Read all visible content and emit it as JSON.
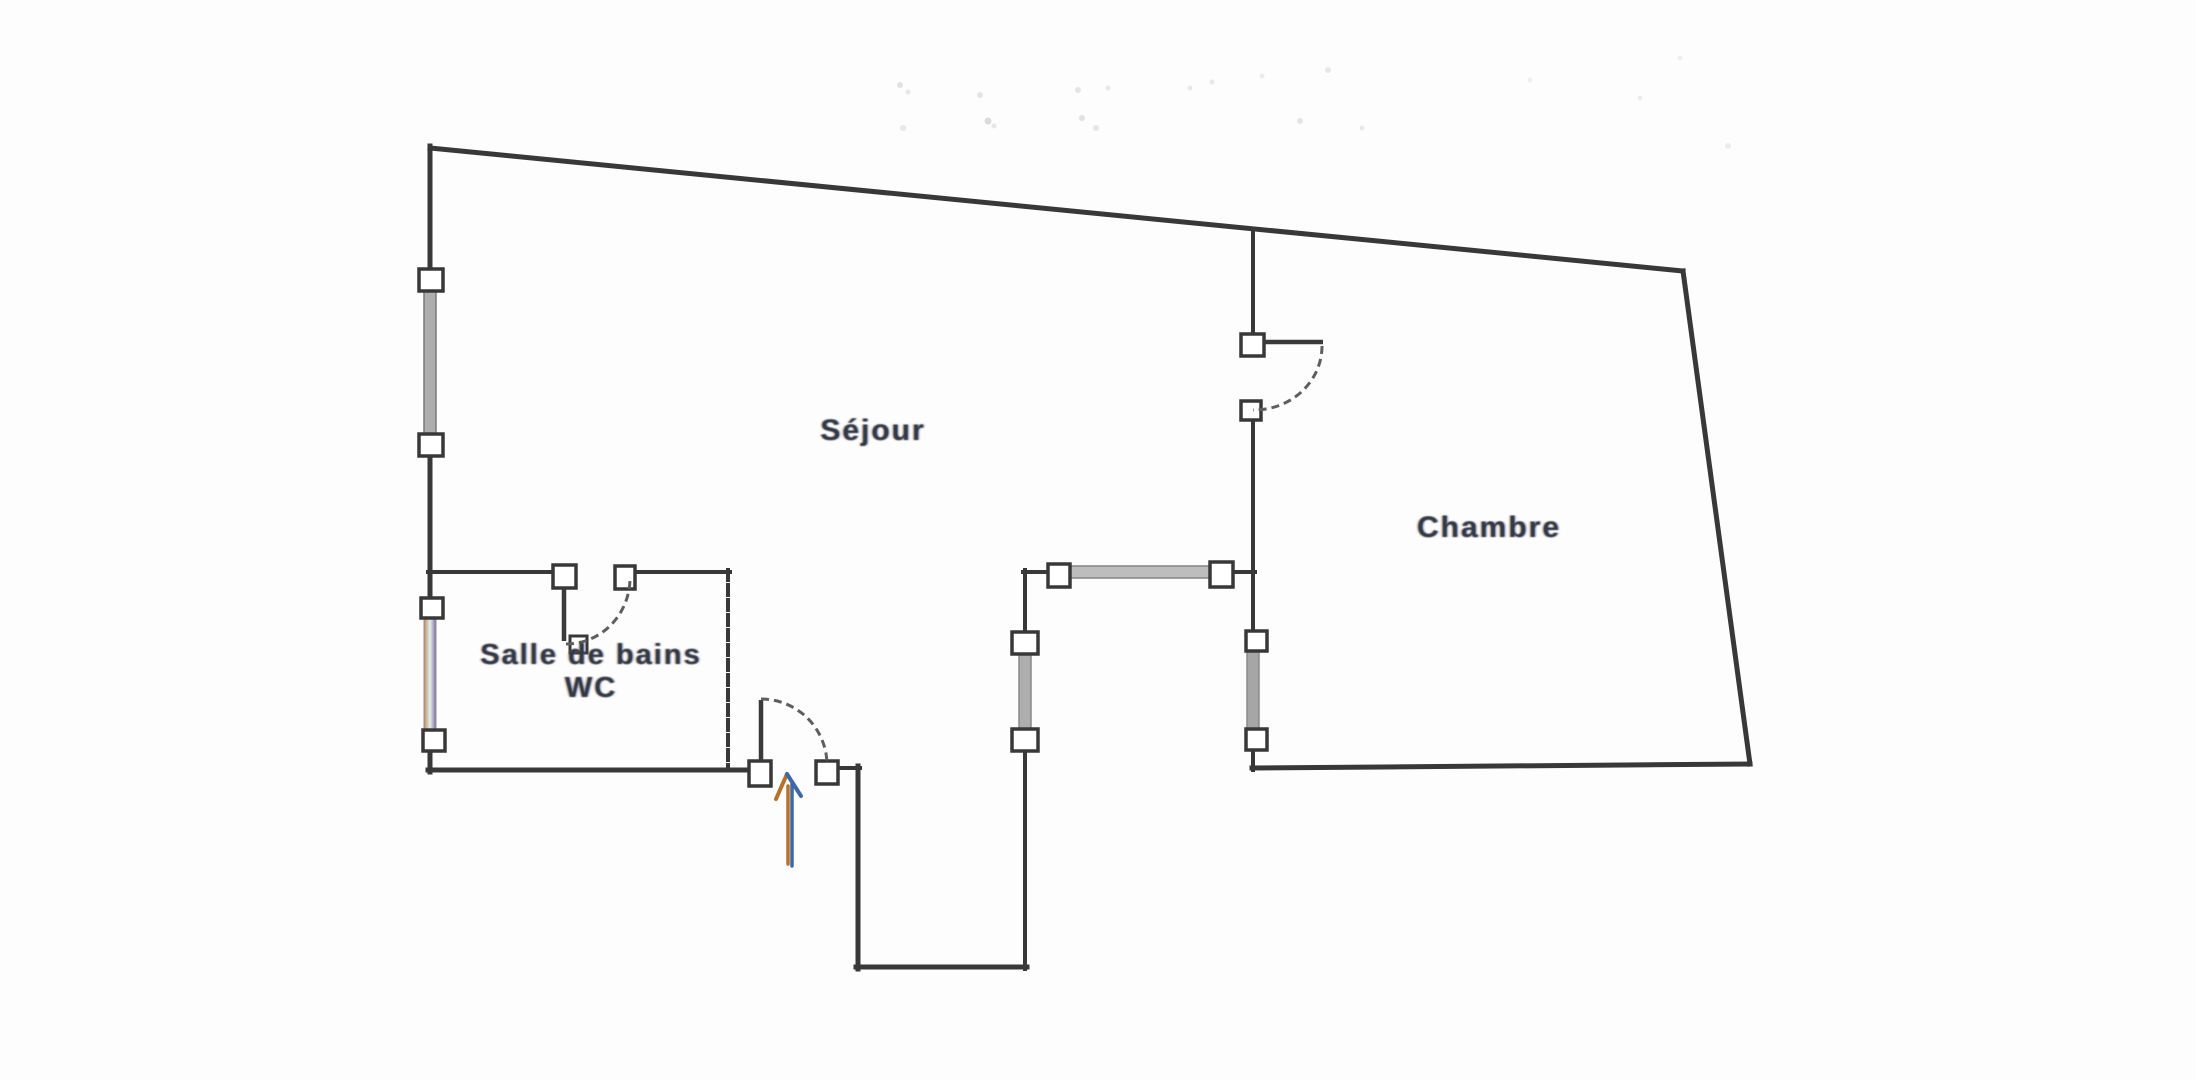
{
  "document": {
    "kind": "apartment floor plan (scanned drawing)",
    "background_color": "#fdfdfd"
  },
  "rooms": {
    "sejour": {
      "label": "Séjour"
    },
    "chambre": {
      "label": "Chambre"
    },
    "salle_de_bains": {
      "label_line1": "Salle de bains",
      "label_line2": "WC"
    }
  },
  "plan_symbols": {
    "doors": [
      "entry-door-swing",
      "bathroom-door-swing",
      "chambre-door-swing"
    ],
    "windows": [
      "left-wall-window-upper",
      "left-wall-window-lower",
      "sejour-south-window",
      "hall-west-window",
      "chambre-west-window"
    ],
    "entry_arrow": "entry-direction-arrow-up"
  },
  "colors": {
    "wall": "#383838",
    "window_fill": "#aeaeae",
    "window_edge": "#7a7a7a",
    "door_arc": "#5e5e5e",
    "label_text": "#333a46",
    "arrow_blue": "#3e69a8",
    "arrow_orange": "#b5722a"
  }
}
